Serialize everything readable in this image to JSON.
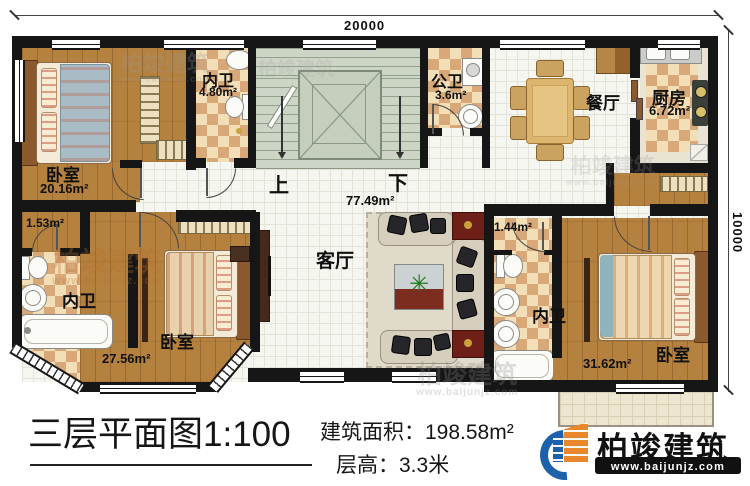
{
  "dimensions": {
    "width_label": "20000",
    "height_label": "10000"
  },
  "stairs": {
    "up_label": "上",
    "down_label": "下"
  },
  "rooms": {
    "bedroom_top_left": {
      "label": "卧室",
      "area": "20.16m²"
    },
    "bathroom_top_left": {
      "label": "内卫",
      "area": "4.80m²"
    },
    "public_bathroom": {
      "label": "公卫",
      "area": "3.6m²"
    },
    "dining_room": {
      "label": "餐厅"
    },
    "kitchen": {
      "label": "厨房",
      "area": "6.72m²"
    },
    "closet_left": {
      "area": "1.53m²"
    },
    "bathroom_bottom_left": {
      "label": "内卫"
    },
    "bedroom_bottom_left": {
      "label": "卧室",
      "area": "27.56m²"
    },
    "living_room": {
      "label": "客厅",
      "area": "77.49m²"
    },
    "closet_right": {
      "area": "1.44m²"
    },
    "bathroom_bottom_right": {
      "label": "内卫"
    },
    "bedroom_bottom_right": {
      "label": "卧室",
      "area": "31.62m²"
    }
  },
  "title_block": {
    "plan_title": "三层平面图1:100",
    "building_area": "建筑面积：198.58m²",
    "floor_height": "层高：3.3米"
  },
  "brand": {
    "name": "柏竣建筑",
    "website": "www.baijunjz.com"
  }
}
